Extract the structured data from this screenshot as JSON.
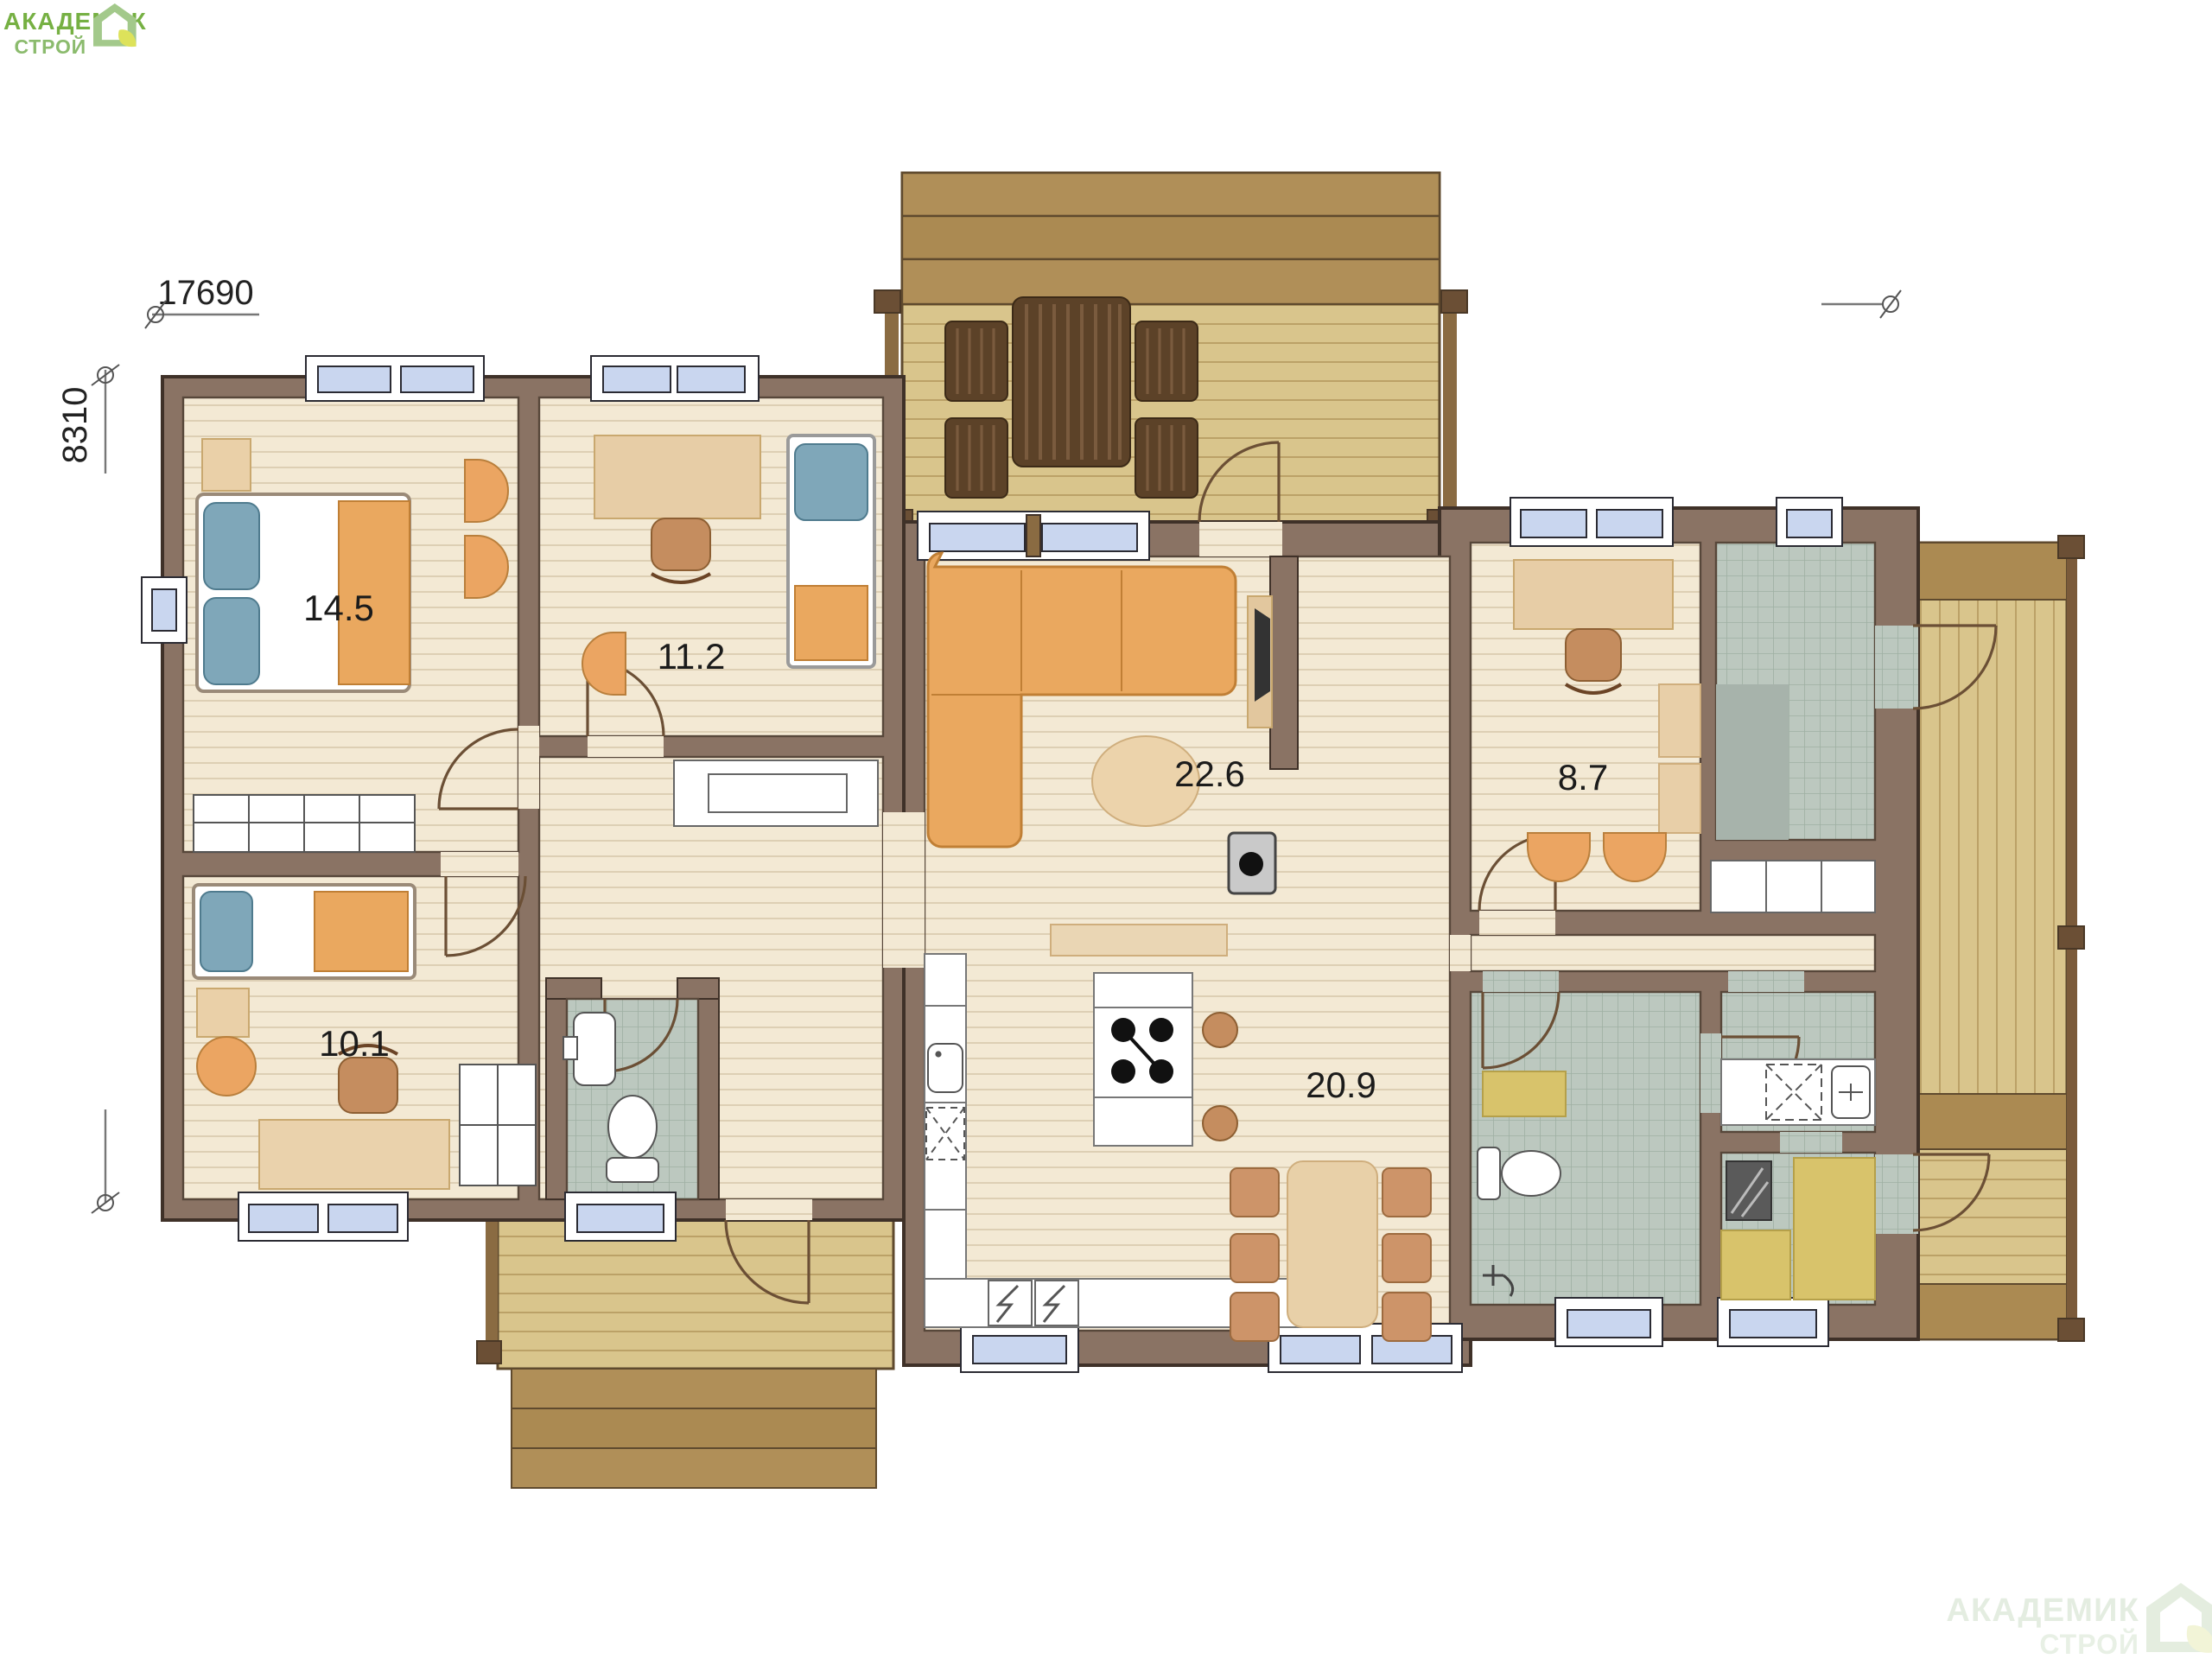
{
  "brand": {
    "line1": "АКАДЕМИК",
    "line2": "СТРОЙ"
  },
  "watermark": {
    "line1": "АКАДЕМИК",
    "line2": "СТРОЙ"
  },
  "plan": {
    "dimension_width_mm": "17690",
    "dimension_height_mm": "8310",
    "rooms": [
      {
        "name": "bedroom-master",
        "area_label": "14.5"
      },
      {
        "name": "bedroom-office",
        "area_label": "11.2"
      },
      {
        "name": "living-room",
        "area_label": "22.6"
      },
      {
        "name": "office",
        "area_label": "8.7"
      },
      {
        "name": "bedroom-small",
        "area_label": "10.1"
      },
      {
        "name": "kitchen-dining",
        "area_label": "20.9"
      }
    ],
    "colors": {
      "wall": "#8a7364",
      "floor": "#f3e9d4",
      "terrace_deck": "#d9c58c",
      "terrace_steps": "#b08f58",
      "tile_green": "#bcc8bf",
      "furniture_orange": "#eaa85f",
      "furniture_beige": "#e8d0a8",
      "dark_wood": "#5c4228",
      "window_glass": "#c9d6ef",
      "sauna_bench": "#d8c36b",
      "logo_green": "#76b043",
      "logo_light_green": "#8bbb6d"
    }
  }
}
